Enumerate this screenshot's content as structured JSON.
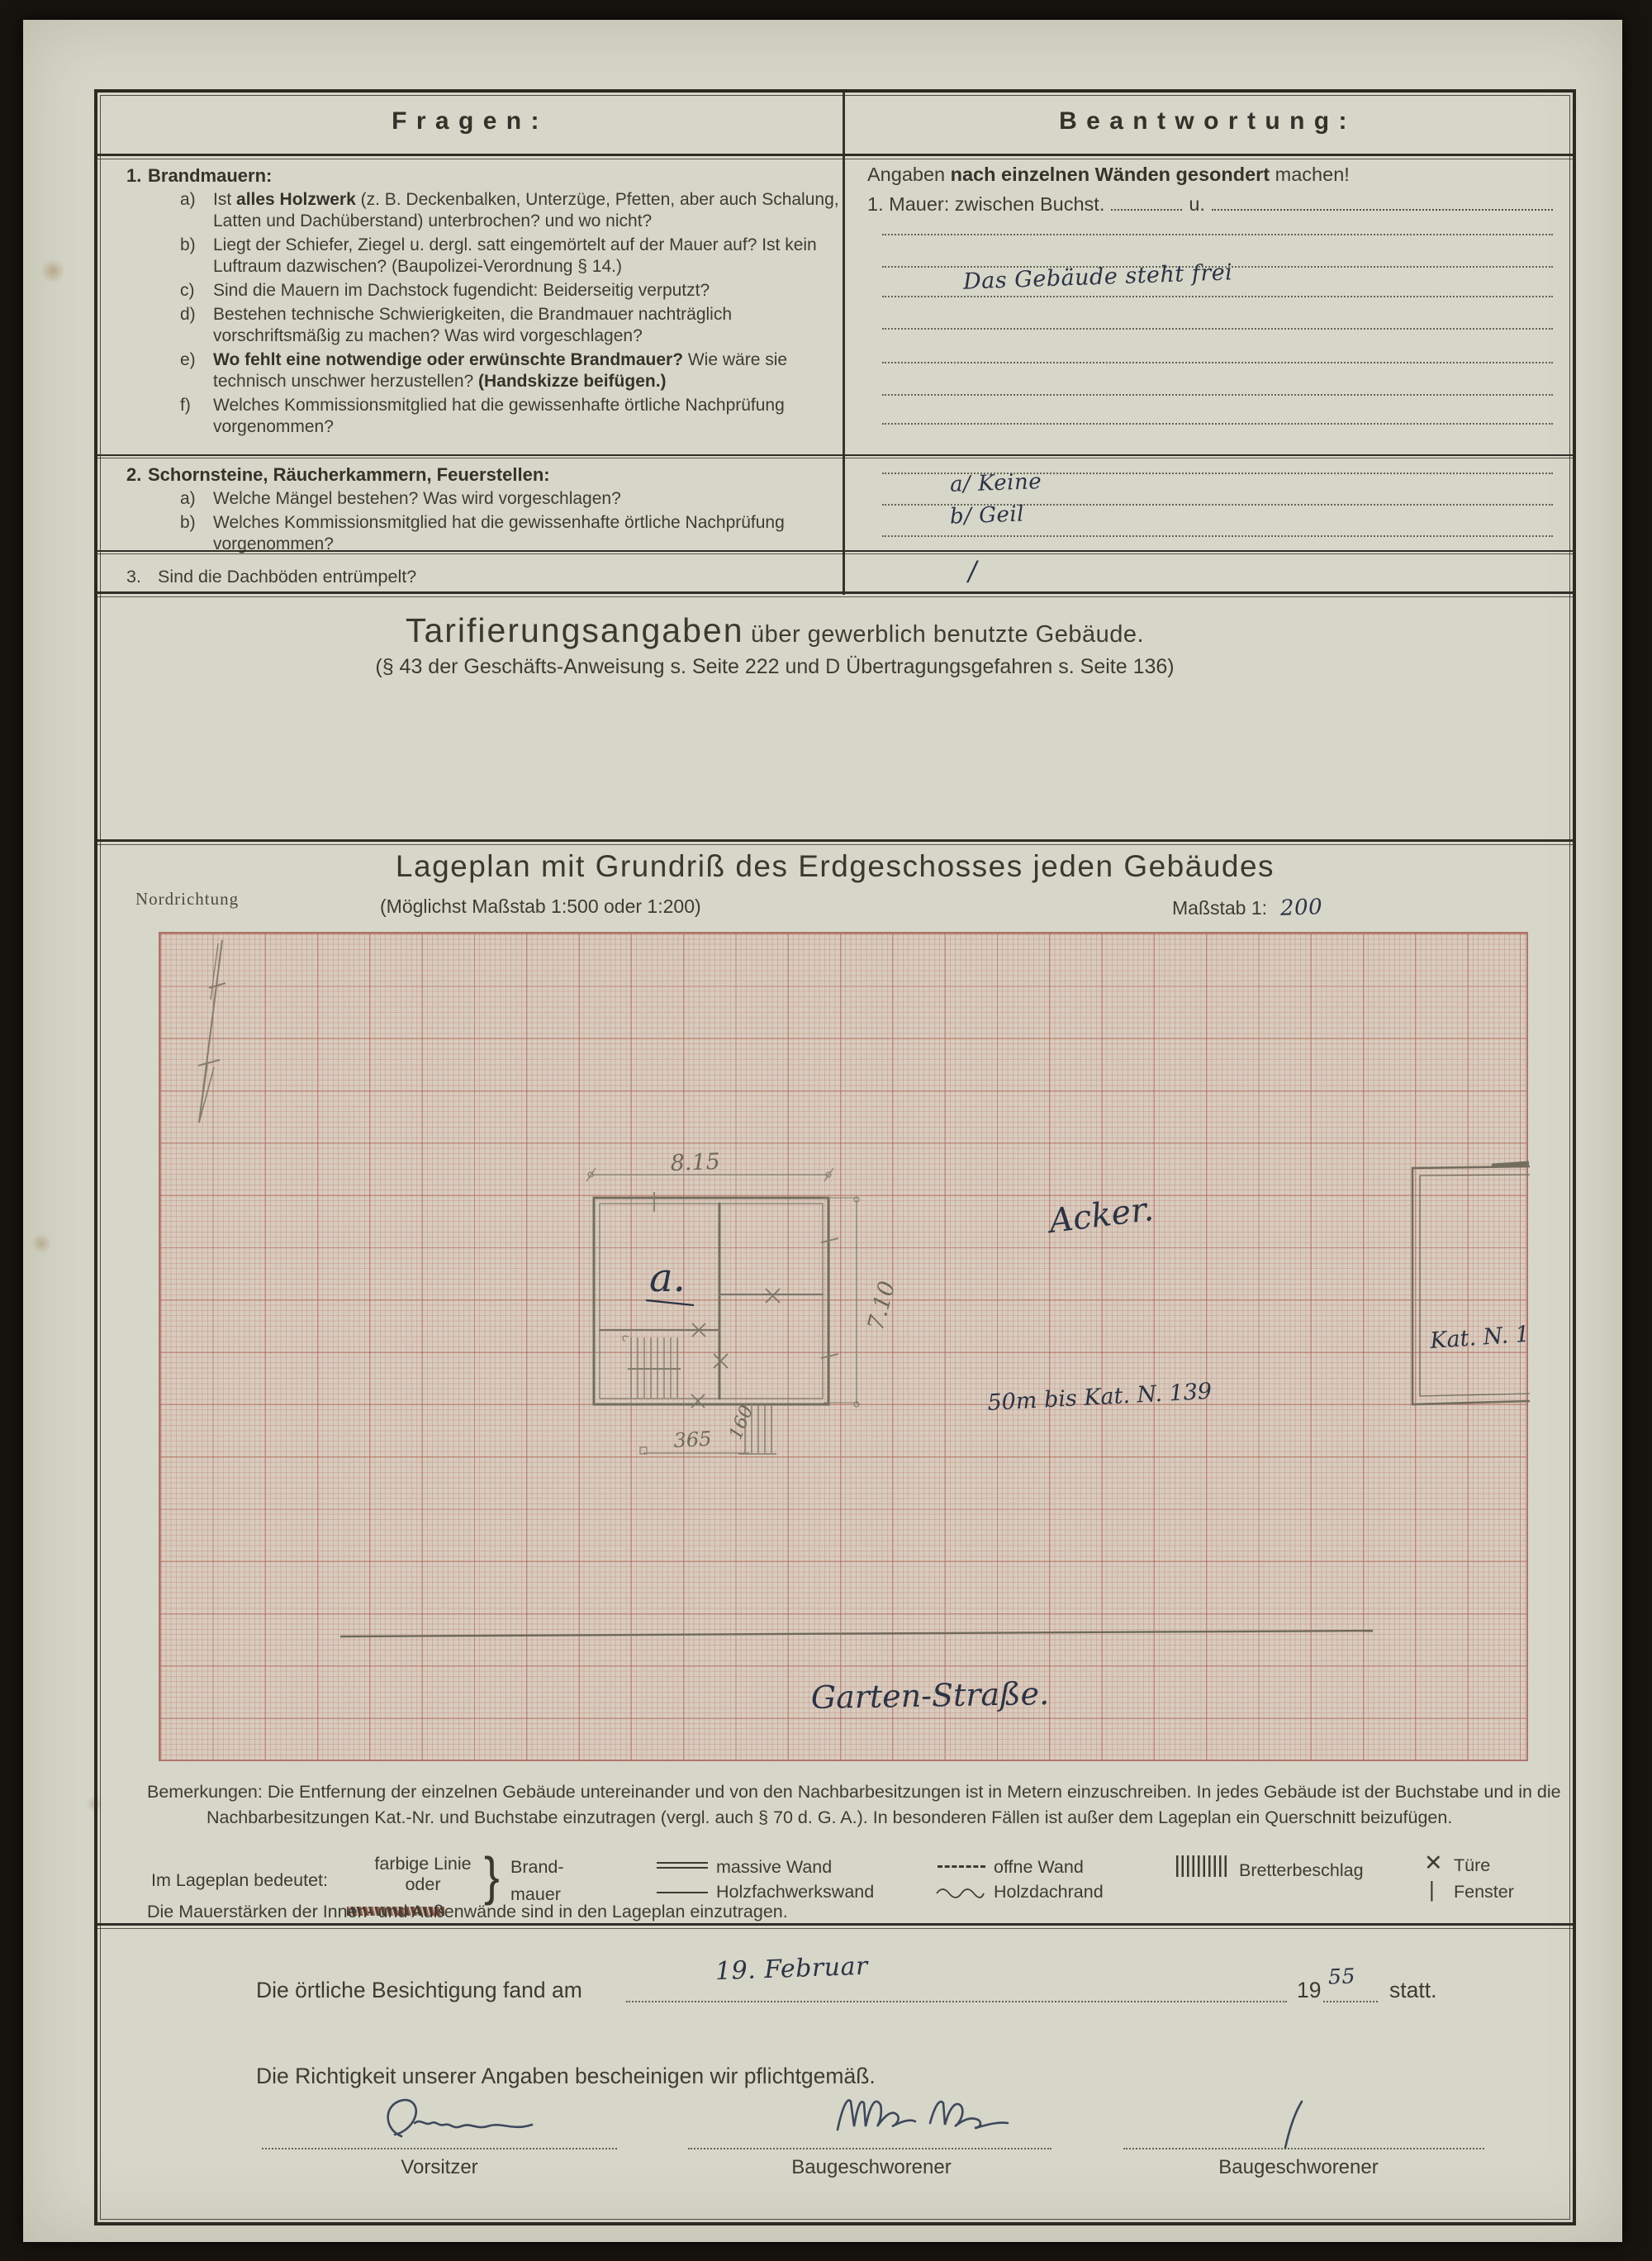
{
  "header": {
    "fragen": "Fragen:",
    "beantwortung": "Beantwortung:"
  },
  "q1": {
    "num": "1.",
    "title": "Brandmauern:",
    "items": [
      {
        "label": "a)",
        "parts": [
          {
            "t": "Ist ",
            "b": 0
          },
          {
            "t": "alles Holzwerk",
            "b": 1
          },
          {
            "t": " (z. B. Deckenbalken, Unterzüge, Pfetten, aber auch Schalung, Latten und Dachüberstand) unterbrochen? und wo nicht?",
            "b": 0
          }
        ]
      },
      {
        "label": "b)",
        "parts": [
          {
            "t": "Liegt der Schiefer, Ziegel u. dergl. satt eingemörtelt auf der Mauer auf? Ist kein Luftraum dazwischen? (Baupolizei-Verordnung § 14.)",
            "b": 0
          }
        ]
      },
      {
        "label": "c)",
        "parts": [
          {
            "t": "Sind die Mauern im Dachstock fugendicht: Beiderseitig verputzt?",
            "b": 0
          }
        ]
      },
      {
        "label": "d)",
        "parts": [
          {
            "t": "Bestehen technische Schwierigkeiten, die Brandmauer nachträglich vorschriftsmäßig zu machen? Was wird vorgeschlagen?",
            "b": 0
          }
        ]
      },
      {
        "label": "e)",
        "parts": [
          {
            "t": "Wo fehlt eine notwendige oder erwünschte Brandmauer?",
            "b": 1
          },
          {
            "t": " Wie wäre sie technisch unschwer herzustellen? ",
            "b": 0
          },
          {
            "t": "(Handskizze beifügen.)",
            "b": 1
          }
        ]
      },
      {
        "label": "f)",
        "parts": [
          {
            "t": "Welches Kommissionsmitglied hat die gewissenhafte örtliche Nachprüfung vorgenommen?",
            "b": 0
          }
        ]
      }
    ]
  },
  "q2": {
    "num": "2.",
    "title": "Schornsteine, Räucherkammern, Feuerstellen:",
    "items": [
      {
        "label": "a)",
        "parts": [
          {
            "t": "Welche Mängel bestehen? Was wird vorgeschlagen?",
            "b": 0
          }
        ]
      },
      {
        "label": "b)",
        "parts": [
          {
            "t": "Welches Kommissionsmitglied hat die gewissenhafte örtliche Nachprüfung vorgenommen?",
            "b": 0
          }
        ]
      }
    ]
  },
  "q3": {
    "num": "3.",
    "text": "Sind die Dachböden entrümpelt?"
  },
  "answers": {
    "intro_parts": [
      {
        "t": "Angaben ",
        "b": 0
      },
      {
        "t": "nach einzelnen Wänden gesondert",
        "b": 1
      },
      {
        "t": " machen!",
        "b": 0
      }
    ],
    "mauer_pre": "1. Mauer:  zwischen  Buchst.",
    "mauer_u": "u.",
    "wall_note": "Das Gebäude steht frei",
    "q2a": "a/ Keine",
    "q2b": "b/ Geil",
    "q3_mark": "/"
  },
  "tarif": {
    "title": "Tarifierungsangaben",
    "title2": " über gewerblich benutzte Gebäude.",
    "subtitle": "(§ 43 der Geschäfts-Anweisung s. Seite 222 und D Übertragungsgefahren s. Seite 136)"
  },
  "lageplan": {
    "title": "Lageplan mit Grundriß des Erdgeschosses jeden Gebäudes",
    "subtitle": "(Möglichst Maßstab 1:500 oder 1:200)",
    "masstab_label": "Maßstab 1:",
    "masstab_value": "200",
    "nordrichtung": "Nordrichtung",
    "plan": {
      "building_label": "a.",
      "dim_width": "8.15",
      "dim_height": "7.10",
      "dim_porch": "365",
      "dim_steps": "160",
      "field_label": "Acker.",
      "distance_note": "50m bis Kat. N. 139",
      "neighbor_label": "Kat. N. 134",
      "street_label": "Garten-Straße."
    }
  },
  "bemerkungen": {
    "label": "Bemerkungen:",
    "text": "Die Entfernung der einzelnen Gebäude untereinander und von den Nachbarbesitzungen ist in Metern einzuschreiben.  In jedes Gebäude ist der Buchstabe und in die Nachbarbesitzungen Kat.-Nr. und Buchstabe einzutragen (vergl. auch § 70 d. G. A.).  In besonderen Fällen ist außer dem Lageplan ein Querschnitt beizufügen."
  },
  "legend": {
    "label": "Im Lageplan bedeutet:",
    "farbige1": "farbige Linie",
    "farbige2": "oder",
    "brand1": "Brand-",
    "brand2": "mauer",
    "massive": "massive Wand",
    "holzfachwerk": "Holzfachwerkswand",
    "offne": "offne Wand",
    "holzdach": "Holzdachrand",
    "bretter": "Bretterbeschlag",
    "tuere": "Türe",
    "fenster": "Fenster",
    "tuere_symbol": "✕",
    "fenster_symbol": "|",
    "brace": "}",
    "mauerstaerken": "Die Mauerstärken der Innen- und Außenwände sind in den Lageplan einzutragen."
  },
  "bottom": {
    "besichtigung_pre": "Die örtliche Besichtigung fand am",
    "date_hand": "19. Februar",
    "year_print": "19",
    "year_hand": "55",
    "statt": "statt.",
    "richtigkeit": "Die Richtigkeit unserer Angaben bescheinigen wir pflichtgemäß.",
    "sig1_label": "Vorsitzer",
    "sig2_label": "Baugeschworener",
    "sig3_label": "Baugeschworener",
    "sig3_mark": "/"
  },
  "colors": {
    "paper": "#d6d7c9",
    "graph_bg": "#d8ccbe",
    "grid_red": "#ad6052",
    "ink": "#2b3345",
    "pencil": "#837d6e",
    "frame": "#2b2a22"
  }
}
